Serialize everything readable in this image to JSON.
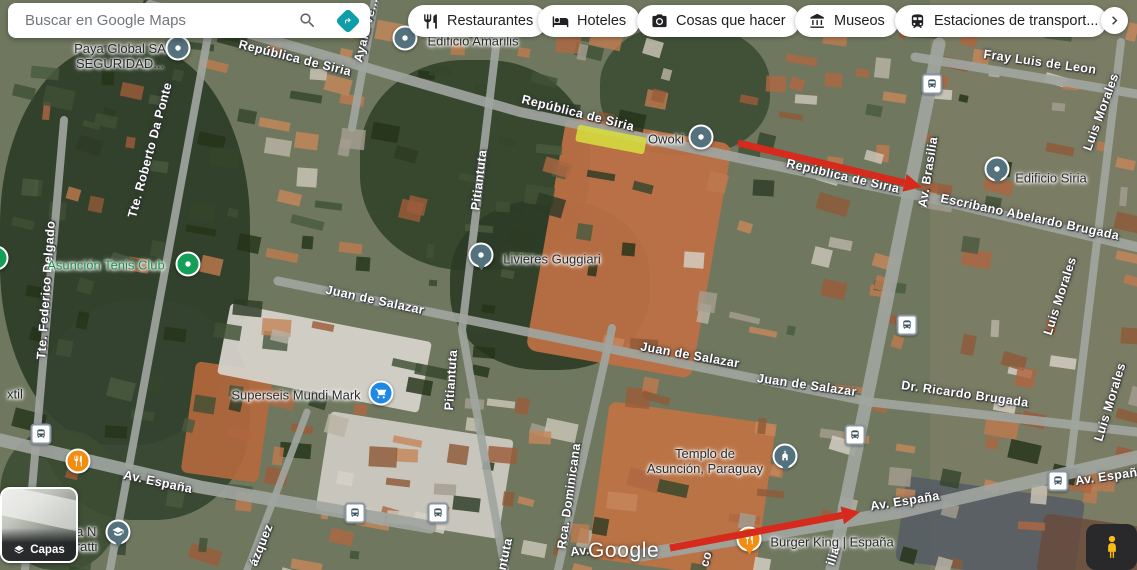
{
  "search": {
    "placeholder": "Buscar en Google Maps"
  },
  "chips": [
    {
      "label": "Restaurantes",
      "icon": "restaurant-icon"
    },
    {
      "label": "Hoteles",
      "icon": "hotel-icon"
    },
    {
      "label": "Cosas que hacer",
      "icon": "camera-icon"
    },
    {
      "label": "Museos",
      "icon": "museum-icon"
    },
    {
      "label": "Estaciones de transport...",
      "icon": "train-icon"
    }
  ],
  "controls": {
    "layers_label": "Capas"
  },
  "watermark": {
    "text": "Google"
  },
  "colors": {
    "accent_teal": "#0f9da8",
    "marker_slate": "#54727e",
    "marker_green": "#149f57",
    "marker_blue": "#1e88e5",
    "marker_orange": "#f18d10",
    "arrow_red": "#d62a1c",
    "highlight_yellow": "#d5dd3d",
    "poi_green_text": "#1e9150"
  },
  "map": {
    "street_labels": [
      {
        "text": "República de Siria",
        "x": 295,
        "y": 58,
        "rot": 14
      },
      {
        "text": "República de Siria",
        "x": 578,
        "y": 113,
        "rot": 14
      },
      {
        "text": "República de Siria",
        "x": 843,
        "y": 176,
        "rot": 13
      },
      {
        "text": "Fray Luis de Leon",
        "x": 1040,
        "y": 62,
        "rot": 8
      },
      {
        "text": "Escribano Abelardo Brugada",
        "x": 1030,
        "y": 217,
        "rot": 12
      },
      {
        "text": "Juan de Salazar",
        "x": 375,
        "y": 300,
        "rot": 12
      },
      {
        "text": "Juan de Salazar",
        "x": 690,
        "y": 355,
        "rot": 10
      },
      {
        "text": "Juan de Salazar",
        "x": 807,
        "y": 385,
        "rot": 8
      },
      {
        "text": "Dr. Ricardo Brugada",
        "x": 965,
        "y": 394,
        "rot": 8
      },
      {
        "text": "Av. España",
        "x": 158,
        "y": 482,
        "rot": 12
      },
      {
        "text": "Av. España",
        "x": 905,
        "y": 501,
        "rot": -9
      },
      {
        "text": "Av. España",
        "x": 1110,
        "y": 476,
        "rot": -8
      },
      {
        "text": "Av.",
        "x": 580,
        "y": 551,
        "rot": -6
      },
      {
        "text": "Ayala Ve...",
        "x": 366,
        "y": 30,
        "rot": -76
      },
      {
        "text": "Tte. Roberto Da Ponte",
        "x": 150,
        "y": 150,
        "rot": -75
      },
      {
        "text": "Pitiantuta",
        "x": 479,
        "y": 180,
        "rot": -83
      },
      {
        "text": "Pitiantuta",
        "x": 451,
        "y": 380,
        "rot": -86
      },
      {
        "text": "ntuta",
        "x": 505,
        "y": 554,
        "rot": -78
      },
      {
        "text": "Av. Brasilia",
        "x": 928,
        "y": 172,
        "rot": -81
      },
      {
        "text": "ilia",
        "x": 833,
        "y": 556,
        "rot": -72
      },
      {
        "text": "co",
        "x": 706,
        "y": 559,
        "rot": -75
      },
      {
        "text": "Luis Morales",
        "x": 1101,
        "y": 112,
        "rot": -70
      },
      {
        "text": "Luis Morales",
        "x": 1060,
        "y": 296,
        "rot": -72
      },
      {
        "text": "Luis Morales",
        "x": 1110,
        "y": 402,
        "rot": -73
      },
      {
        "text": "Tte. Federico Delgado",
        "x": 46,
        "y": 290,
        "rot": -86
      },
      {
        "text": "Rca. Dominicana",
        "x": 569,
        "y": 496,
        "rot": -82
      },
      {
        "text": "ázquez",
        "x": 261,
        "y": 545,
        "rot": -68
      }
    ],
    "pois": [
      {
        "lines": [
          "Paya Global SA",
          "SEGURIDAD..."
        ],
        "tx": 120,
        "ty": 56,
        "marker": {
          "shape": "circle",
          "color": "marker_slate",
          "glyph": "dot"
        },
        "mx": 178,
        "my": 48
      },
      {
        "lines": [
          "Edificio Amarilis"
        ],
        "tx": 473,
        "ty": 41,
        "marker": {
          "shape": "circle",
          "color": "marker_slate",
          "glyph": "dot"
        },
        "mx": 405,
        "my": 38
      },
      {
        "lines": [
          "Owoki"
        ],
        "tx": 666,
        "ty": 139,
        "marker": {
          "shape": "circle",
          "color": "marker_slate",
          "glyph": "dot"
        },
        "mx": 701,
        "my": 137
      },
      {
        "lines": [
          "Edificio Siria"
        ],
        "tx": 1051,
        "ty": 178,
        "marker": {
          "shape": "pin",
          "color": "marker_slate",
          "glyph": "dot"
        },
        "mx": 997,
        "my": 169
      },
      {
        "lines": [
          "Asunción Tenis Club"
        ],
        "tx": 106,
        "ty": 265,
        "text_color": "poi_green_text",
        "marker": {
          "shape": "circle",
          "color": "marker_green",
          "glyph": "dot"
        },
        "mx": 188,
        "my": 264
      },
      {
        "lines": [
          "Livieres Guggiari"
        ],
        "tx": 552,
        "ty": 259,
        "marker": {
          "shape": "pin",
          "color": "marker_slate",
          "glyph": "dot"
        },
        "mx": 481,
        "my": 255
      },
      {
        "lines": [
          "Superseis Mundi Mark"
        ],
        "tx": 296,
        "ty": 395,
        "marker": {
          "shape": "circle",
          "color": "marker_blue",
          "glyph": "cart"
        },
        "mx": 381,
        "my": 393
      },
      {
        "lines": [
          "Templo de",
          "Asunción, Paraguay"
        ],
        "tx": 705,
        "ty": 461,
        "marker": {
          "shape": "pin",
          "color": "marker_slate",
          "glyph": "church"
        },
        "mx": 785,
        "my": 456
      },
      {
        "lines": [
          "Burger King | España"
        ],
        "tx": 832,
        "ty": 542,
        "marker": {
          "shape": "pin",
          "color": "marker_orange",
          "glyph": "fork"
        },
        "mx": 749,
        "my": 539
      },
      {
        "lines": [
          "ca N",
          "eratti"
        ],
        "tx": 83,
        "ty": 539,
        "marker": {
          "shape": "pin",
          "color": "marker_slate",
          "glyph": "cap"
        },
        "mx": 118,
        "my": 532
      },
      {
        "lines": [
          "xtil"
        ],
        "tx": 15,
        "ty": 394
      },
      {
        "marker": {
          "shape": "circle",
          "color": "marker_orange",
          "glyph": "fork"
        },
        "mx": 78,
        "my": 461
      },
      {
        "marker": {
          "shape": "circle",
          "color": "marker_green",
          "glyph": "dot"
        },
        "mx": -4,
        "my": 258
      }
    ],
    "transit_stops": [
      {
        "x": 41,
        "y": 434
      },
      {
        "x": 355,
        "y": 513
      },
      {
        "x": 438,
        "y": 513
      },
      {
        "x": 855,
        "y": 435
      },
      {
        "x": 907,
        "y": 325
      },
      {
        "x": 932,
        "y": 84
      },
      {
        "x": 1058,
        "y": 481
      }
    ],
    "annotations": {
      "arrows": [
        {
          "x1": 738,
          "y1": 143,
          "x2": 922,
          "y2": 187
        },
        {
          "x1": 670,
          "y1": 548,
          "x2": 860,
          "y2": 512
        }
      ],
      "highlights": [
        {
          "x": 611,
          "y": 139,
          "w": 70,
          "h": 17,
          "rot": 11
        }
      ]
    }
  }
}
